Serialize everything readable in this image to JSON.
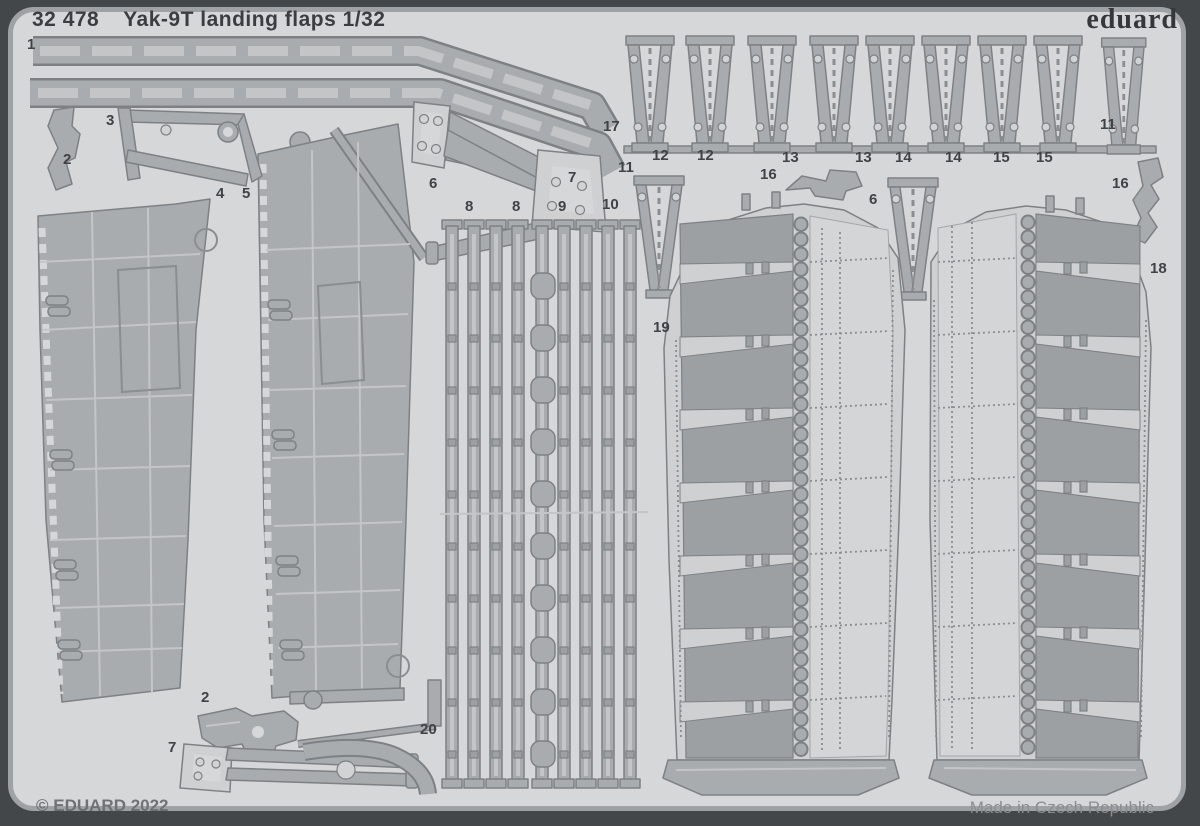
{
  "sheet": {
    "code": "32 478",
    "title": "Yak-9T landing flaps 1/32",
    "brand": "eduard",
    "copyright": "© EDUARD 2022",
    "made_in": "Made in Czech Republic",
    "scale": "1/32",
    "subject": "Yak-9T landing flaps"
  },
  "colors": {
    "frame": "#44474a",
    "sheet_background": "#d6d7d8",
    "sheet_rim": "#9fa2a4",
    "metal_part": "#a9acaf",
    "metal_dark": "#9ca0a2",
    "metal_light": "#ced0d1",
    "outline": "#7e8183",
    "text_dark": "#3a3e41",
    "text_gray": "#6e7275"
  },
  "part_labels": [
    {
      "n": "1",
      "x": 27,
      "y": 37
    },
    {
      "n": "2",
      "x": 63,
      "y": 152
    },
    {
      "n": "3",
      "x": 106,
      "y": 113
    },
    {
      "n": "4",
      "x": 216,
      "y": 186
    },
    {
      "n": "5",
      "x": 242,
      "y": 186
    },
    {
      "n": "6",
      "x": 429,
      "y": 176
    },
    {
      "n": "7",
      "x": 568,
      "y": 170
    },
    {
      "n": "8",
      "x": 465,
      "y": 199
    },
    {
      "n": "8",
      "x": 512,
      "y": 199
    },
    {
      "n": "9",
      "x": 558,
      "y": 199
    },
    {
      "n": "10",
      "x": 602,
      "y": 197
    },
    {
      "n": "17",
      "x": 603,
      "y": 119
    },
    {
      "n": "11",
      "x": 618,
      "y": 160
    },
    {
      "n": "11",
      "x": 1100,
      "y": 117
    },
    {
      "n": "12",
      "x": 652,
      "y": 148
    },
    {
      "n": "12",
      "x": 697,
      "y": 148
    },
    {
      "n": "13",
      "x": 782,
      "y": 150
    },
    {
      "n": "13",
      "x": 855,
      "y": 150
    },
    {
      "n": "14",
      "x": 895,
      "y": 150
    },
    {
      "n": "14",
      "x": 945,
      "y": 150
    },
    {
      "n": "15",
      "x": 993,
      "y": 150
    },
    {
      "n": "15",
      "x": 1036,
      "y": 150
    },
    {
      "n": "16",
      "x": 760,
      "y": 167
    },
    {
      "n": "16",
      "x": 1112,
      "y": 176
    },
    {
      "n": "6",
      "x": 869,
      "y": 192
    },
    {
      "n": "18",
      "x": 1150,
      "y": 261
    },
    {
      "n": "19",
      "x": 653,
      "y": 320
    },
    {
      "n": "2",
      "x": 201,
      "y": 690
    },
    {
      "n": "7",
      "x": 168,
      "y": 740
    },
    {
      "n": "20",
      "x": 420,
      "y": 722
    }
  ]
}
